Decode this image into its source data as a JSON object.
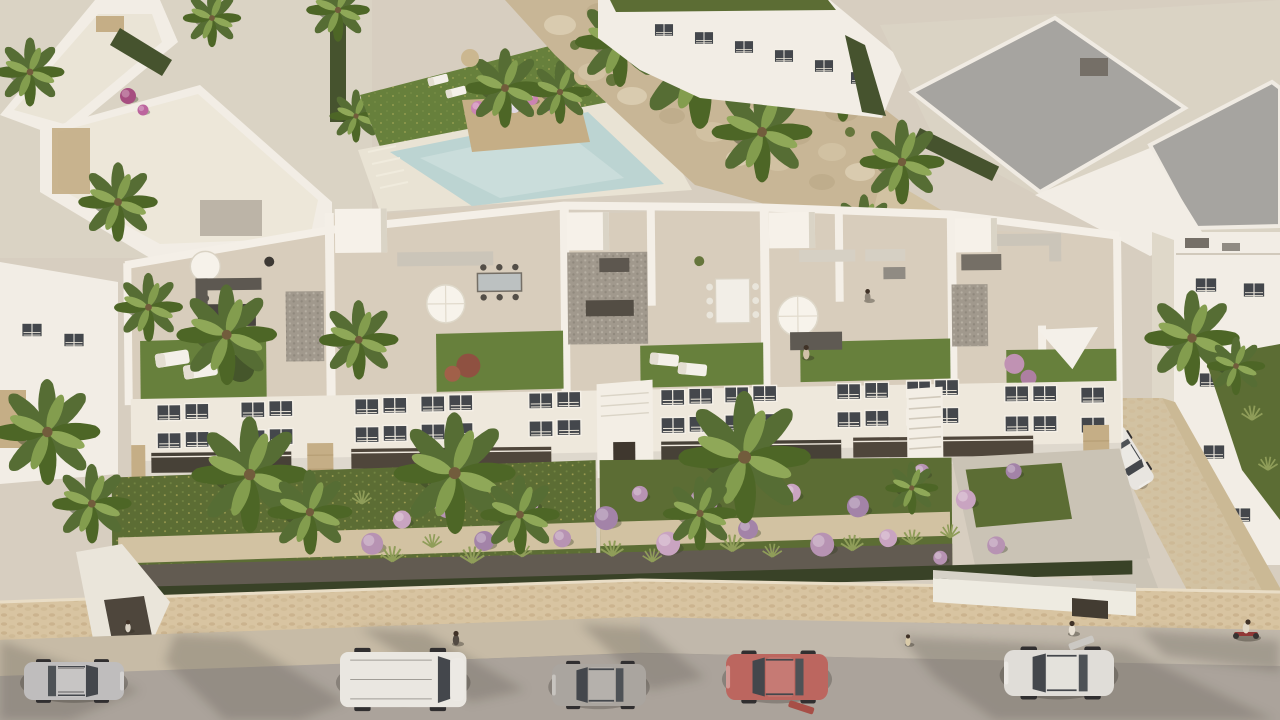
{
  "scene": {
    "type": "aerial-architectural-render",
    "description": "Bird's-eye 3D rendering of a new-build white Mediterranean apartment complex with rooftop solarium terraces, landscaped gardens with palms and lilac shrub balls, a stone perimeter wall, and a street with parked cars in front. Neighbouring villas, a communal pool and a rocky landscaped slope sit behind the block.",
    "lighting": "warm late-afternoon sun from the upper right, long soft shadows toward lower left",
    "main_building": {
      "style": "modern white Mediterranean apartment block",
      "rooftop_terraces": 5,
      "terrace_features": [
        "beige tile flooring",
        "artificial lawn patches",
        "white parasols",
        "outdoor sofas",
        "dining sets",
        "sun loungers",
        "white shade sail",
        "gravel light-wells"
      ],
      "facade_features": [
        "dark glazed windows with louvre shutters",
        "recessed balconies",
        "sand-stone clad columns",
        "external staircases"
      ]
    },
    "surroundings": {
      "pool": "communal pool with planter island and sun deck",
      "rock_garden": "boulder-covered slope between villa rows",
      "neighbour_villas": "white flat-roof villas, some with grey roofs",
      "street": "asphalt road with stone sidewalk and perimeter wall entrances"
    },
    "cars": [
      {
        "id": "silver-suv",
        "description": "silver SUV parked far left",
        "color": "#b5b5b7"
      },
      {
        "id": "white-van",
        "description": "white panel van",
        "color": "#e9e8e4"
      },
      {
        "id": "gray-hatchback",
        "description": "warm-grey hatchback",
        "color": "#9c9995"
      },
      {
        "id": "red-hatchback",
        "description": "red hatchback with door ajar",
        "color": "#b24f49"
      },
      {
        "id": "white-sedan",
        "description": "white sedan with open driver door",
        "color": "#dcdbd7"
      },
      {
        "id": "driveway-car",
        "description": "white car parked in right driveway",
        "color": "#e5e4e0"
      }
    ],
    "people": [
      {
        "id": "sidewalk-walker",
        "description": "pedestrian on sidewalk near van"
      },
      {
        "id": "sidewalk-child",
        "description": "small child on sidewalk right of centre"
      },
      {
        "id": "entrance-woman",
        "description": "woman at right gate entrance"
      },
      {
        "id": "cyclist",
        "description": "cyclist with red bicycle far right"
      },
      {
        "id": "gate-visitor",
        "description": "person inside left gate passage"
      },
      {
        "id": "terrace-person-1",
        "description": "resident on fourth rooftop lawn"
      },
      {
        "id": "terrace-person-2",
        "description": "resident near fourth terrace parapet"
      }
    ],
    "vegetation": [
      "fan palms",
      "lilac/pink shrub balls",
      "bougainvillea",
      "ornamental grasses",
      "clipped dark hedges",
      "rooftop lawns",
      "wildflower lawn"
    ]
  },
  "palette": {
    "ground": "#d5cec1",
    "ground_light": "#d9d3c6",
    "building_white": "#f2efe8",
    "building_shade": "#ded8cb",
    "facade": "#eee9df",
    "terrace_floor": "#d6cdbd",
    "roof_gray": "#a2a2a0",
    "lawn": "#5f7c36",
    "lawn_dark": "#54682e",
    "pool_water": "#b9d4d4",
    "deck": "#e8e4d6",
    "rock_base": "#c6b595",
    "rock_light": "#d7cbaf",
    "rock_dark": "#bcab8b",
    "hedge_dark": "#3d4c28",
    "hedge_row": "#2f3a20",
    "palm_green": "#4d682e",
    "palm_light": "#7d9a49",
    "wall_stone": "#d6c3a1",
    "path_stone": "#d0c1a2",
    "sidewalk": "#beb7ab",
    "road": "#a7a19a",
    "gravel": "#9c968c",
    "glass_dark": "#3a4047",
    "stone_clad": "#c2ac84",
    "shrub_lilac": "#b490b4",
    "shrub_pink": "#c7a2c2",
    "shrub_mauve": "#9f7fa8",
    "bougainvillea": "#a2477e",
    "furniture_dark": "#4b4845",
    "furniture_white": "#f4f2ec",
    "shadow": "#5f5a52"
  }
}
